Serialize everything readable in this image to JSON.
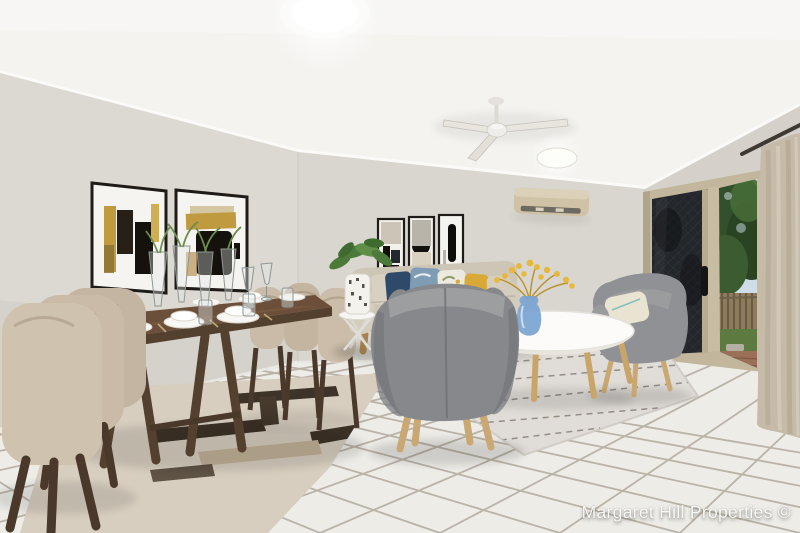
{
  "watermark": {
    "text": "Margaret Hill Properties ©"
  },
  "colors": {
    "ceiling": "#f4f3f0",
    "wall_left": "#dcd9d3",
    "wall_back": "#d9d6d0",
    "wall_right": "#d5d1ca",
    "floor": "#edece7",
    "grout": "#a59b8d",
    "rug_dining": "#d7cebf",
    "rug_pattern_dark": "#3e3328",
    "rug_pattern_light": "#c3b299",
    "rug_living": "#e0dcd7",
    "table_wood": "#6b4f3a",
    "chair_fabric": "#c9bba7",
    "sofa": "#cdc5b6",
    "armchair_gray": "#86888b",
    "armchair_gray_light": "#8f9194",
    "cushion_navy": "#2e4a68",
    "cushion_blue": "#7e9cb4",
    "cushion_yellow": "#d9a937",
    "coffee_table_white": "#fcfbf9",
    "vase_blue": "#7aa3d2",
    "flower_yellow": "#e6b93e",
    "art_gold": "#c09a3e",
    "art_black": "#15110c",
    "ac_beige": "#cfc2a6",
    "door_frame": "#c2b69c",
    "screen_dark": "#23262a",
    "foliage": "#33502c",
    "grass": "#5d7b40",
    "fence_timber": "#8d7b5b",
    "paver_brick": "#9a7058",
    "curtain": "#c6bba9"
  }
}
